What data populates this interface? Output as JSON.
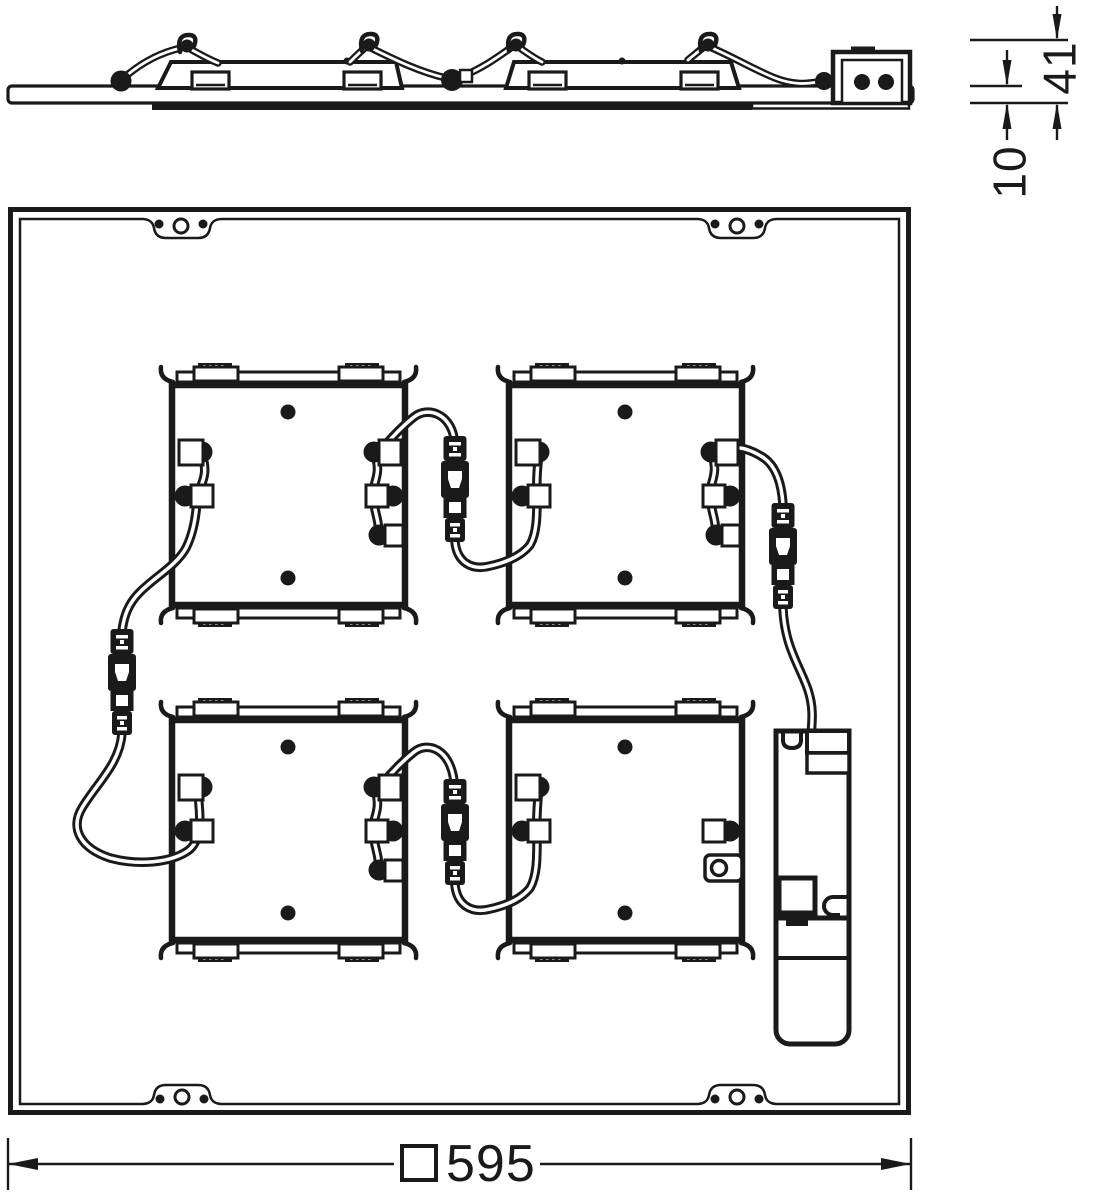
{
  "drawing": {
    "kind": "luminaire-dimension-drawing",
    "views": {
      "side_view": "panel side profile with LED modules and driver",
      "plan_view": "panel rear view with four LED modules, plug connectors and driver box"
    }
  },
  "dimensions": {
    "overall_height": "41",
    "plate_thickness": "10",
    "square_width": "595",
    "square_width_label": "□595",
    "units": "mm"
  },
  "colors": {
    "line": "#1a1a1a",
    "background": "#ffffff"
  }
}
